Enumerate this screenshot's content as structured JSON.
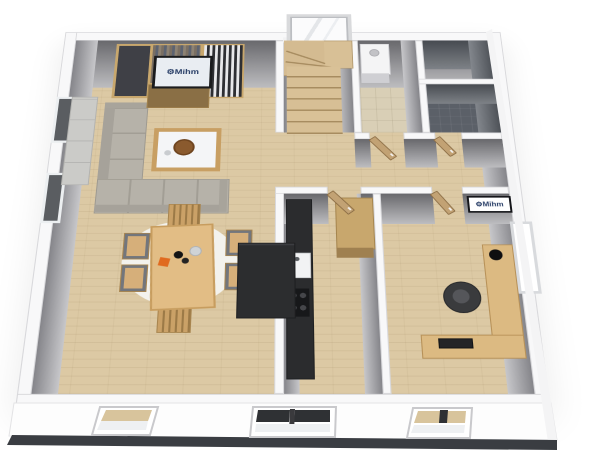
{
  "branding": {
    "gear_glyph": "⚙",
    "tv_logo_text": "Mihm",
    "wall_sign_text": "Mihm"
  },
  "palette": {
    "background": "#ffffff",
    "wall_cap": "#f8f8f9",
    "wall_face_dark": "#68686c",
    "wall_face_light": "#bdbdc0",
    "bath_face_dark": "#474b51",
    "floor_wood": "#dcc9a4",
    "floor_tile_pantry": "#d9cfb6",
    "floor_bath": "#5b6068",
    "furniture_wood": "#c8a76d",
    "sofa_gray": "#b6b2a9",
    "counter_black": "#2b2c2e",
    "plinth_dark": "#3a3d42",
    "logo_blue": "#273d66",
    "accent_orange": "#e06a1f"
  },
  "scene": {
    "view": "3d-perspective-floorplan",
    "rooms": [
      "living-room",
      "dining-area",
      "kitchen",
      "office",
      "hallway",
      "stairwell",
      "pantry",
      "bathroom",
      "utility-room"
    ],
    "open_doors": 4,
    "windows_front_wall": 3,
    "windows_left_wall": 2,
    "windows_right_wall": 1,
    "windows_back_wall": 1
  }
}
